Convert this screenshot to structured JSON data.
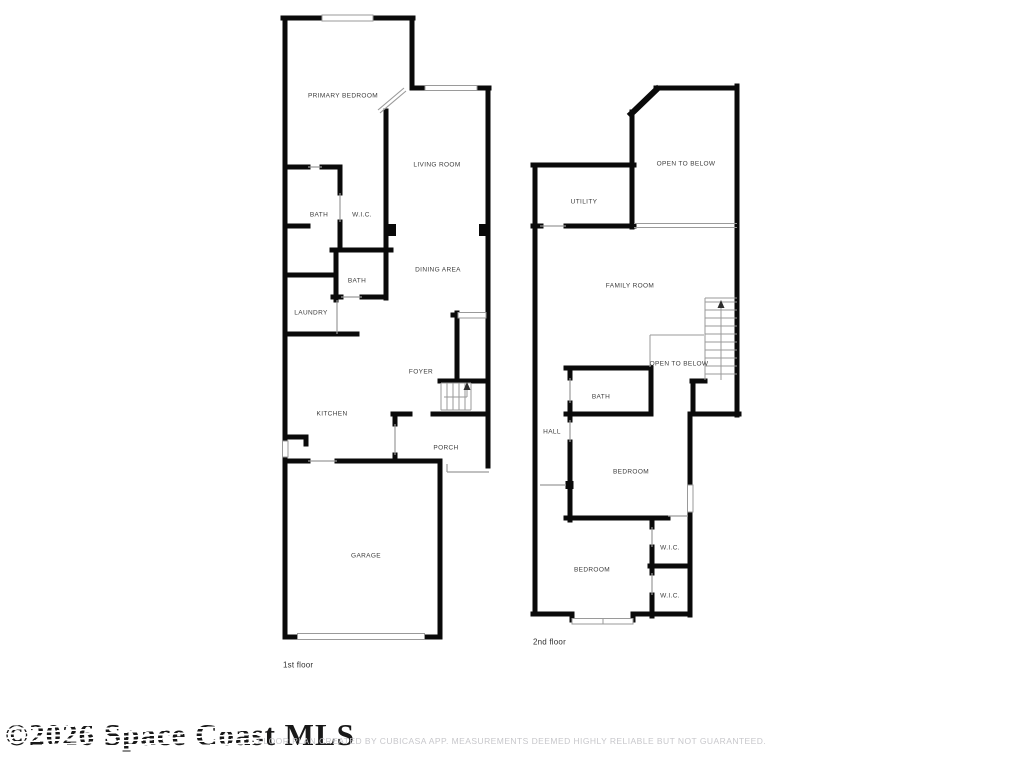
{
  "watermark_text": "©2026 Space Coast MLS",
  "footer_text": "FLOOR PLAN CREATED BY CUBICASA APP. MEASUREMENTS DEEMED HIGHLY RELIABLE BUT NOT GUARANTEED.",
  "colors": {
    "wall": "#0a0a0a",
    "thin_line": "#9a9a9a",
    "label": "#3d3d3d",
    "footer": "#c7c7cb"
  },
  "floors": [
    {
      "caption": "1st floor",
      "rooms": [
        {
          "label": "PRIMARY BEDROOM"
        },
        {
          "label": "LIVING ROOM"
        },
        {
          "label": "BATH"
        },
        {
          "label": "W.I.C."
        },
        {
          "label": "DINING AREA"
        },
        {
          "label": "BATH"
        },
        {
          "label": "LAUNDRY"
        },
        {
          "label": "FOYER"
        },
        {
          "label": "KITCHEN"
        },
        {
          "label": "PORCH"
        },
        {
          "label": "GARAGE"
        }
      ]
    },
    {
      "caption": "2nd floor",
      "rooms": [
        {
          "label": "OPEN TO BELOW"
        },
        {
          "label": "UTILITY"
        },
        {
          "label": "FAMILY ROOM"
        },
        {
          "label": "OPEN TO BELOW"
        },
        {
          "label": "BATH"
        },
        {
          "label": "HALL"
        },
        {
          "label": "BEDROOM"
        },
        {
          "label": "W.I.C."
        },
        {
          "label": "BEDROOM"
        },
        {
          "label": "W.I.C."
        }
      ]
    }
  ]
}
